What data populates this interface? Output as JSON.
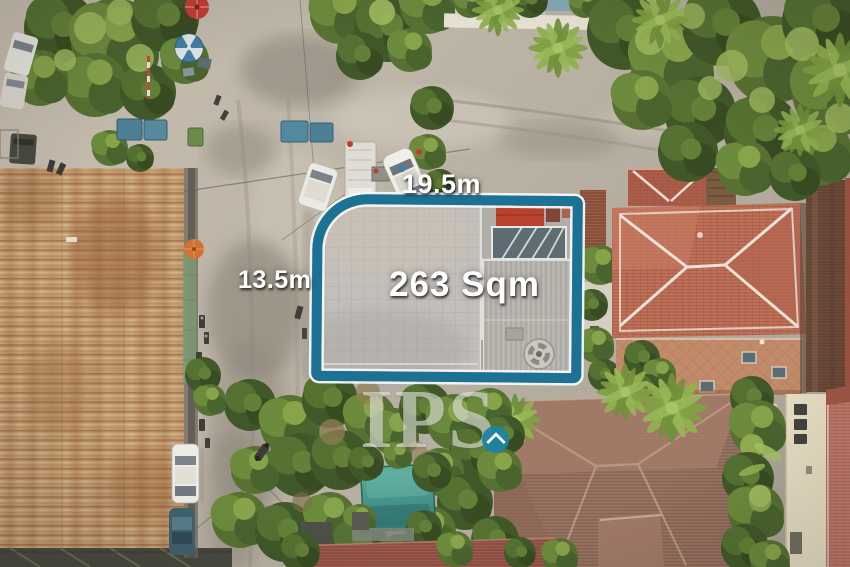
{
  "scene": {
    "type": "aerial-drone-photograph",
    "subject": "corner land plot outlined for sale, surrounded by streets, rusted warehouse roof, villa roofs, trees and a pool"
  },
  "plot": {
    "area_label": "263 Sqm",
    "frontage_label": "19.5m",
    "side_label": "13.5m",
    "outline_color": "#1c7295",
    "label_text_color": "#ffffff"
  },
  "watermark": {
    "brand": "IPS",
    "icon": "chevron-up-icon",
    "circle_color": "#1f84a4"
  }
}
